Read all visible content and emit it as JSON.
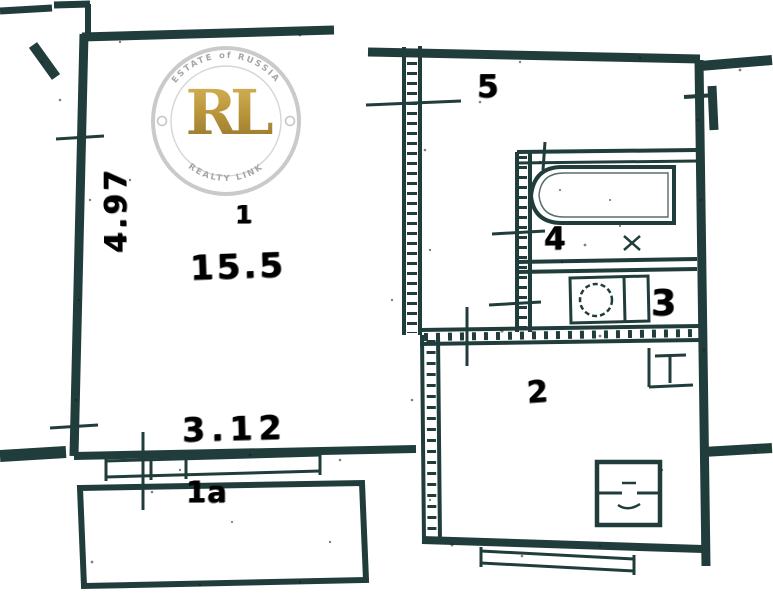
{
  "colors": {
    "paper": "#ffffff",
    "wall": "#203d3b",
    "ink": "#070707",
    "watermark_ring": "#c6c6c6",
    "watermark_text": "#a0a0a0",
    "gold": "#b08c2e"
  },
  "watermark": {
    "arc_top": "ESTATE of RUSSIA",
    "monogram": "RL",
    "arc_bottom": "REALTY LINK"
  },
  "rooms": {
    "room1": {
      "number": "1",
      "area": "15.5"
    },
    "balcony": {
      "label": "1a"
    },
    "kitchen": {
      "label": "2"
    },
    "toilet": {
      "label": "3"
    },
    "bathroom": {
      "label": "4"
    },
    "hallway": {
      "label": "5"
    }
  },
  "dimensions": {
    "room1_width": "3.12",
    "room1_depth": "4.97"
  }
}
